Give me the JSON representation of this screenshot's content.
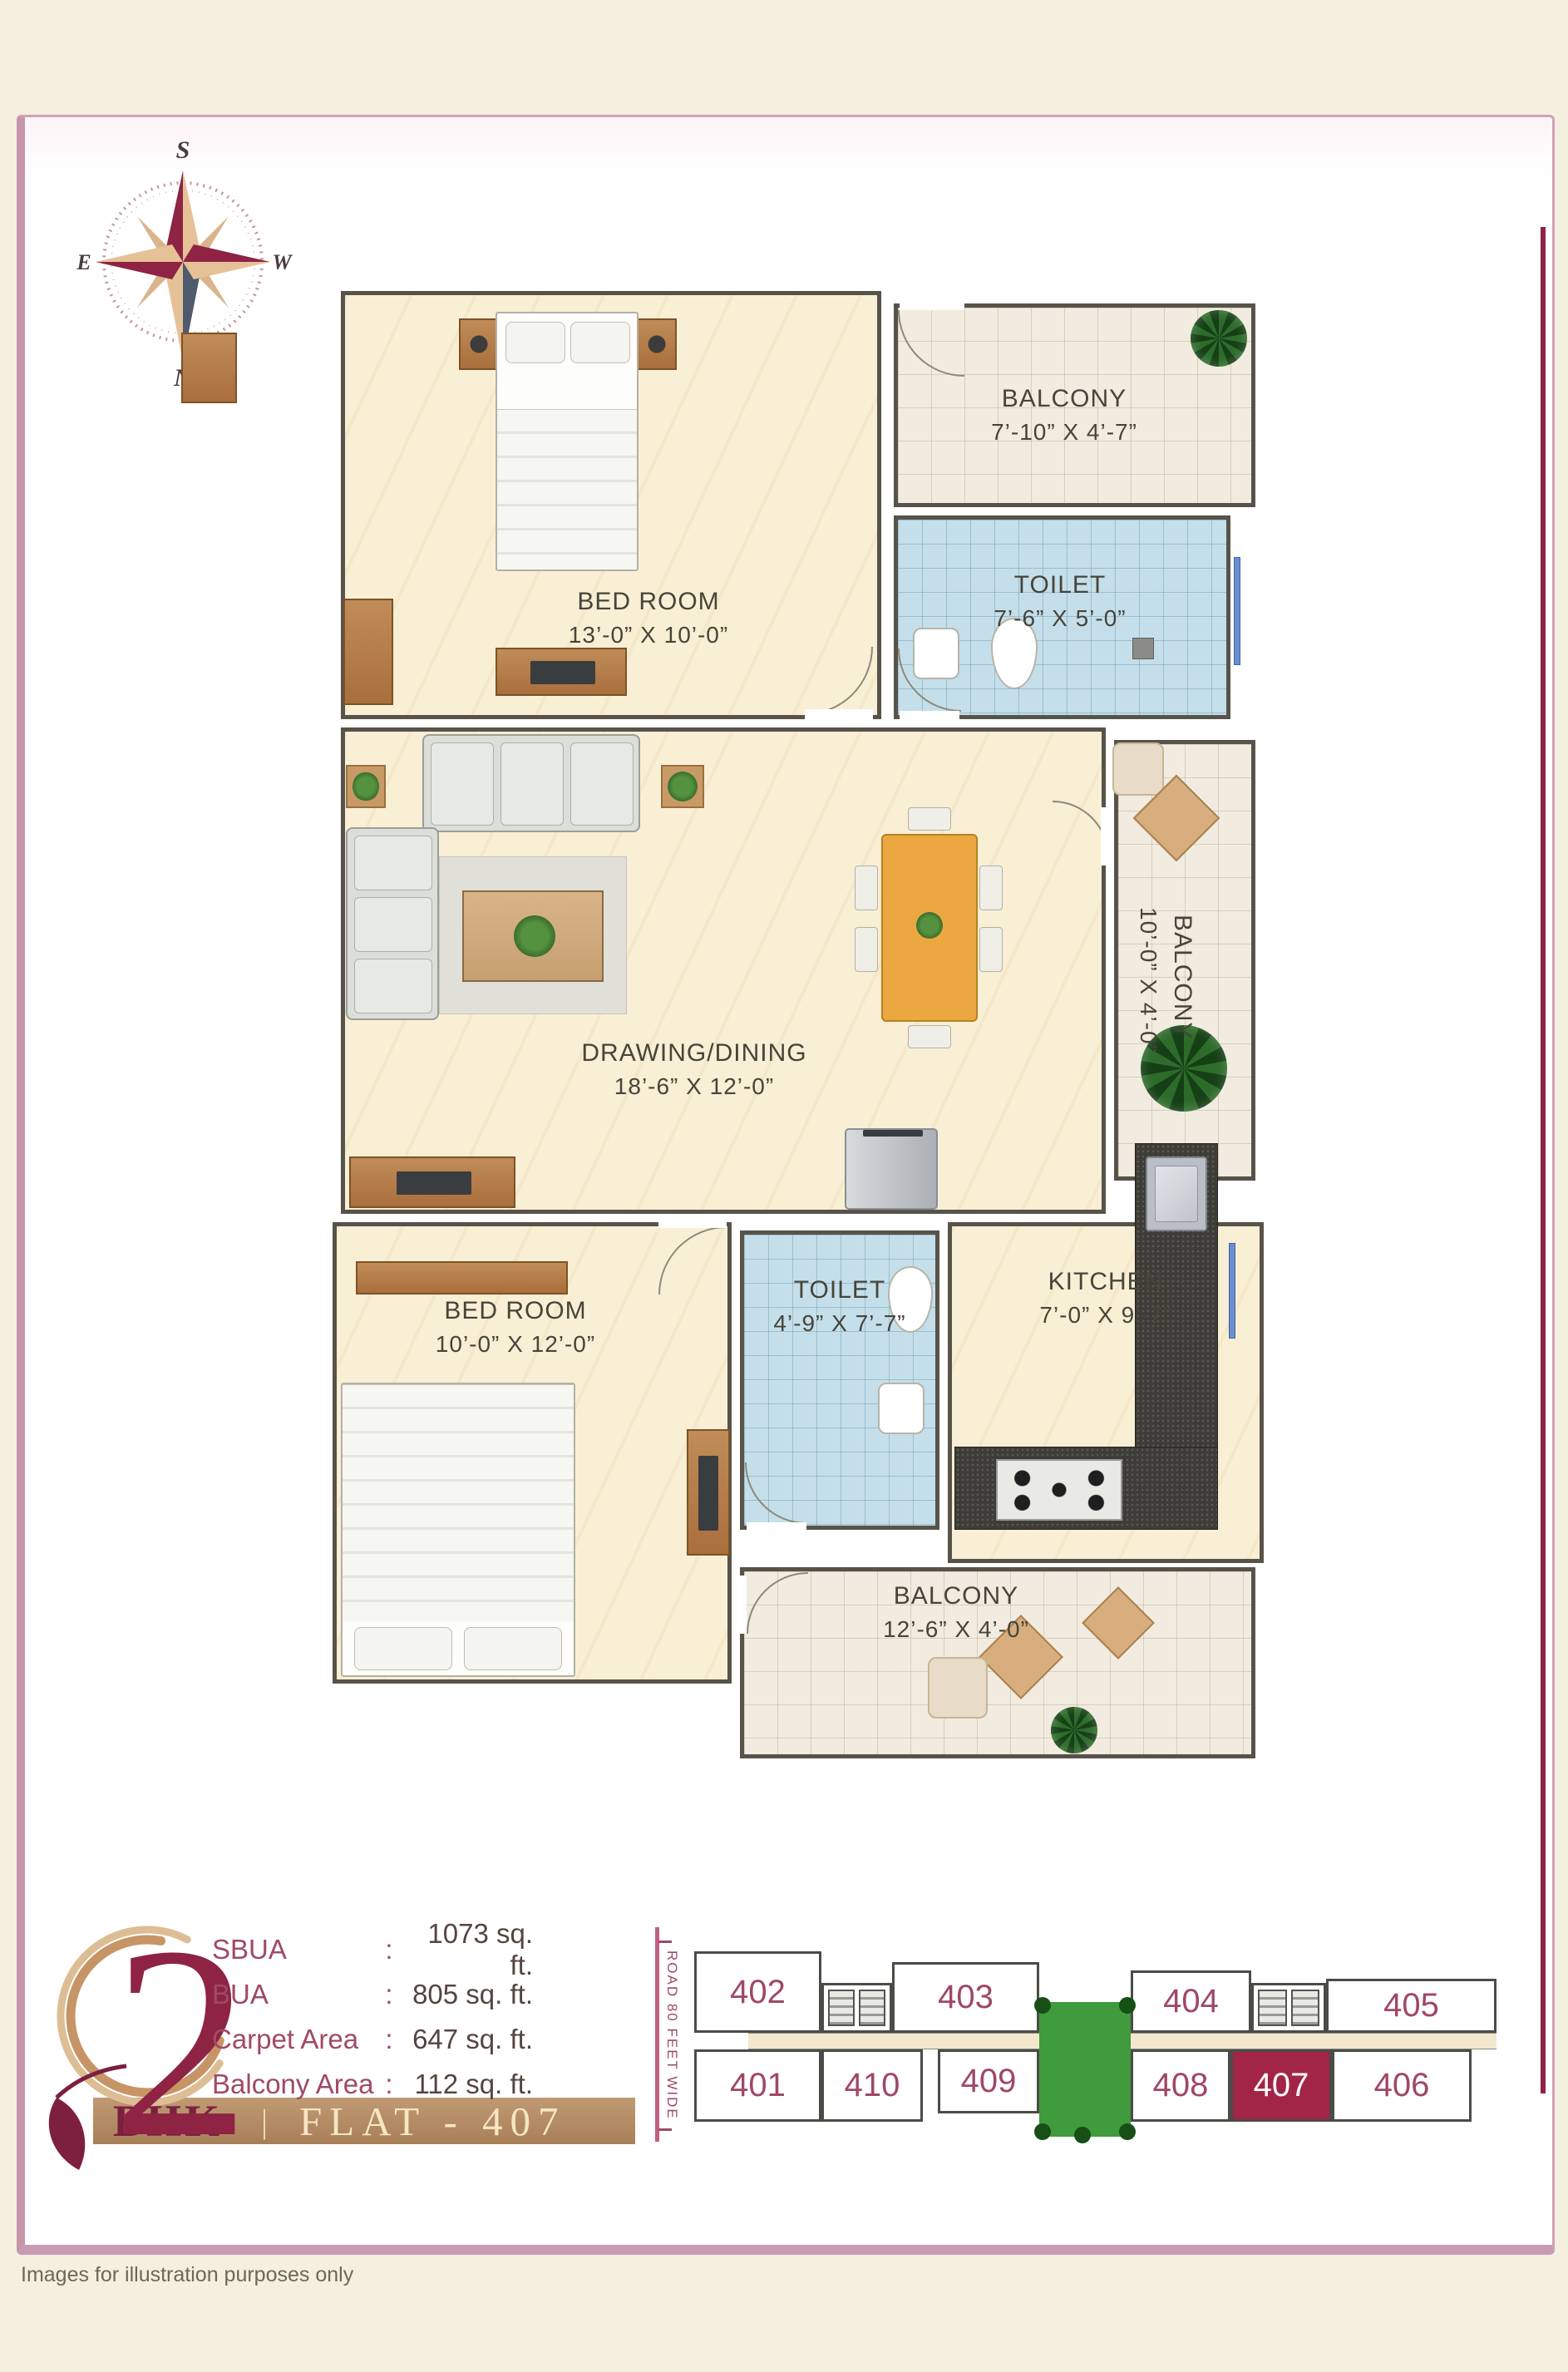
{
  "colors": {
    "accent_maroon": "#8e2344",
    "card_border_pink": "#c795aa",
    "wall_gray": "#57534a",
    "floor_cream": "#f9efd5",
    "toilet_tile_blue": "#c4dfea",
    "banner_tan": "#b28a63",
    "keyplan_number": "#a04766",
    "highlight_flat_bg": "#a22547",
    "courtyard_green": "#3f9b3c"
  },
  "icons": {
    "compass_rose": "4-point-star",
    "logo_leaf": "leaf",
    "stairs_lift": "striped-squares",
    "plants": "green-circle"
  },
  "compass": {
    "top": "S",
    "bottom": "N",
    "left": "E",
    "right": "W"
  },
  "floorplan": {
    "rooms": [
      {
        "name": "BED ROOM",
        "dims": "13’-0” X 10’-0”"
      },
      {
        "name": "BALCONY",
        "dims": "7’-10” X 4’-7”"
      },
      {
        "name": "TOILET",
        "dims": "7’-6” X 5’-0”"
      },
      {
        "name": "DRAWING/DINING",
        "dims": "18’-6” X 12’-0”"
      },
      {
        "name": "BALCONY",
        "dims": "10’-0” X 4’-0”"
      },
      {
        "name": "TOILET",
        "dims": "4’-9” X 7’-7”"
      },
      {
        "name": "KITCHEN",
        "dims": "7’-0” X 9’-7”"
      },
      {
        "name": "BED ROOM",
        "dims": "10’-0” X 12’-0”"
      },
      {
        "name": "BALCONY",
        "dims": "12’-6” X 4’-0”"
      }
    ]
  },
  "info": {
    "unit_number": "2",
    "unit_type": "BHK",
    "divider": "|",
    "flat_label": "FLAT - 407",
    "colon": ":",
    "areas": [
      {
        "label": "SBUA",
        "value": "1073 sq. ft."
      },
      {
        "label": "BUA",
        "value": "805 sq. ft."
      },
      {
        "label": "Carpet Area",
        "value": "647 sq. ft."
      },
      {
        "label": "Balcony Area",
        "value": "112 sq. ft."
      }
    ]
  },
  "keyplan": {
    "road_label": "ROAD 80 FEET WIDE",
    "highlighted_flat": "407",
    "top_row": [
      {
        "number": "402"
      },
      {
        "number": "403"
      },
      {
        "number": "404"
      },
      {
        "number": "405"
      }
    ],
    "bottom_row": [
      {
        "number": "401"
      },
      {
        "number": "410"
      },
      {
        "number": "409"
      },
      {
        "number": "408"
      },
      {
        "number": "407"
      },
      {
        "number": "406"
      }
    ]
  },
  "footer": {
    "note": "Images for illustration purposes only"
  }
}
